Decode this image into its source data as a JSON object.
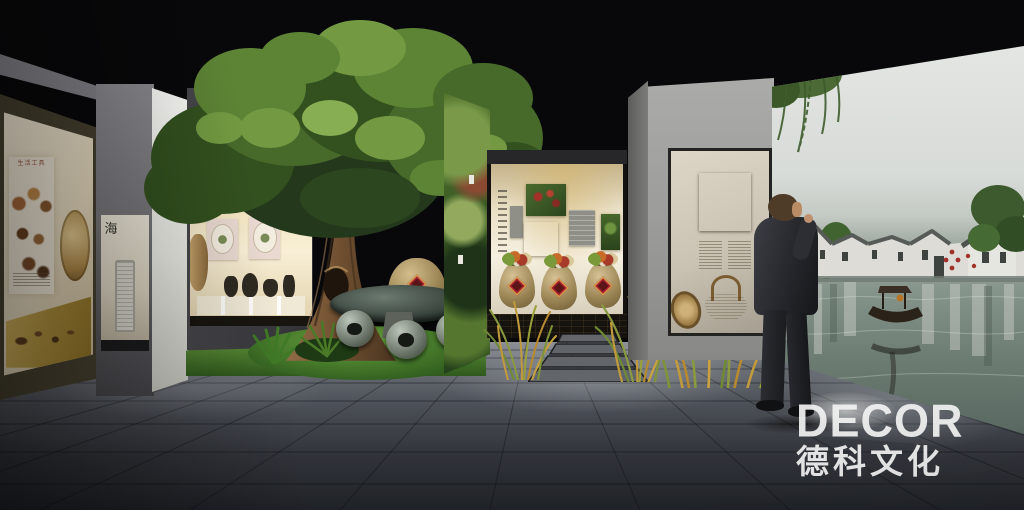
{
  "branding": {
    "logo": "DECOR",
    "logo_cn": "德科文化"
  },
  "signage": {
    "left_exhibit_title": "生活工具",
    "niche_calligraphy": "海"
  },
  "palette": {
    "ceiling": "#08080a",
    "floor_dark": "#26292d",
    "floor_light": "#8d9197",
    "case_glow": "#f3e9d2",
    "gold_case": "#b3933f",
    "foliage_dark": "#24381c",
    "foliage_light": "#87ae52",
    "mural_sky": "#e3e6e3",
    "mural_water": "#6d7d73",
    "jar_label_red": "#ad2430",
    "grass_gold": "#c19a3c",
    "logo_color": "#f2f2f2"
  }
}
